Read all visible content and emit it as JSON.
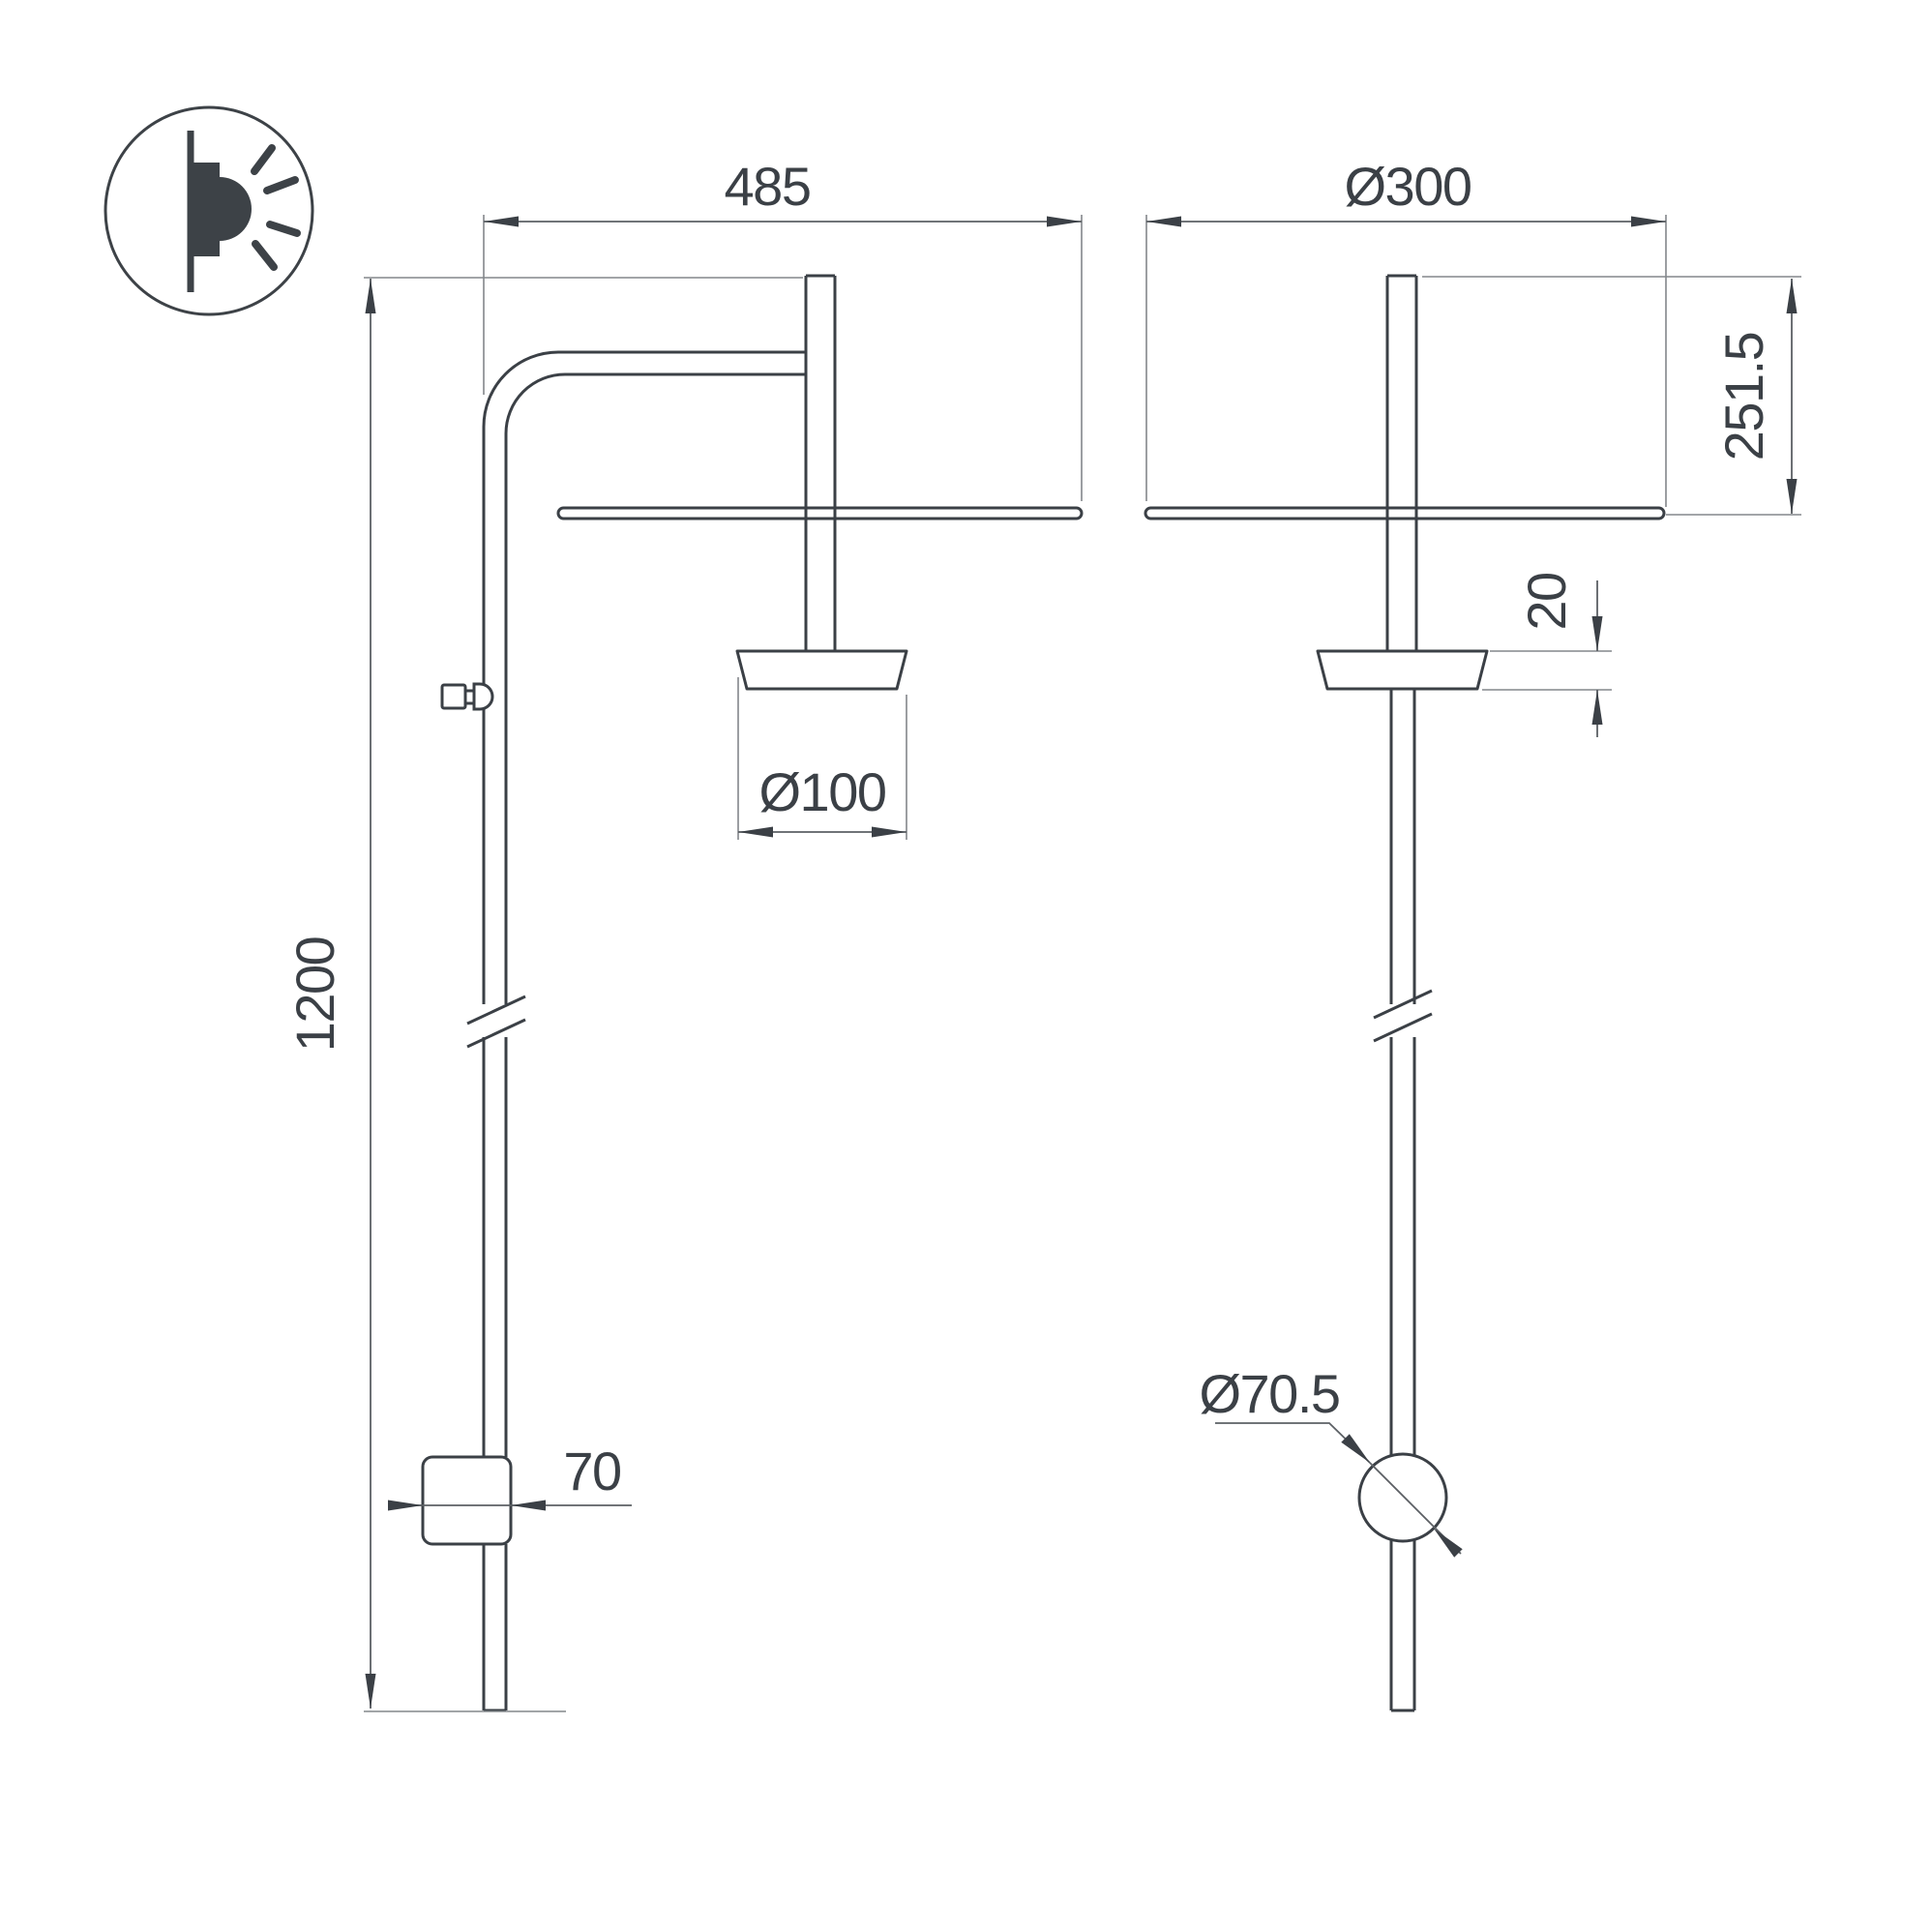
{
  "drawing": {
    "type": "technical-dimension-drawing",
    "subject": "wall-mounted luminaire, front and side orthographic views",
    "colors": {
      "background": "#ffffff",
      "object_line": "#3b4046",
      "dimension_line": "#5c6065",
      "extension_line": "#83878b",
      "text": "#3b4046"
    },
    "icon": {
      "name": "wall-lamp-side-glow-icon"
    },
    "front_view": {
      "dimensions": {
        "arm_reach": "485",
        "cup_diameter": "Ø100",
        "pole_height": "1200",
        "bracket_width": "70"
      }
    },
    "side_view": {
      "dimensions": {
        "shade_diameter": "Ø300",
        "head_drop": "251.5",
        "shade_offset": "20",
        "mount_diameter": "Ø70.5"
      }
    }
  }
}
